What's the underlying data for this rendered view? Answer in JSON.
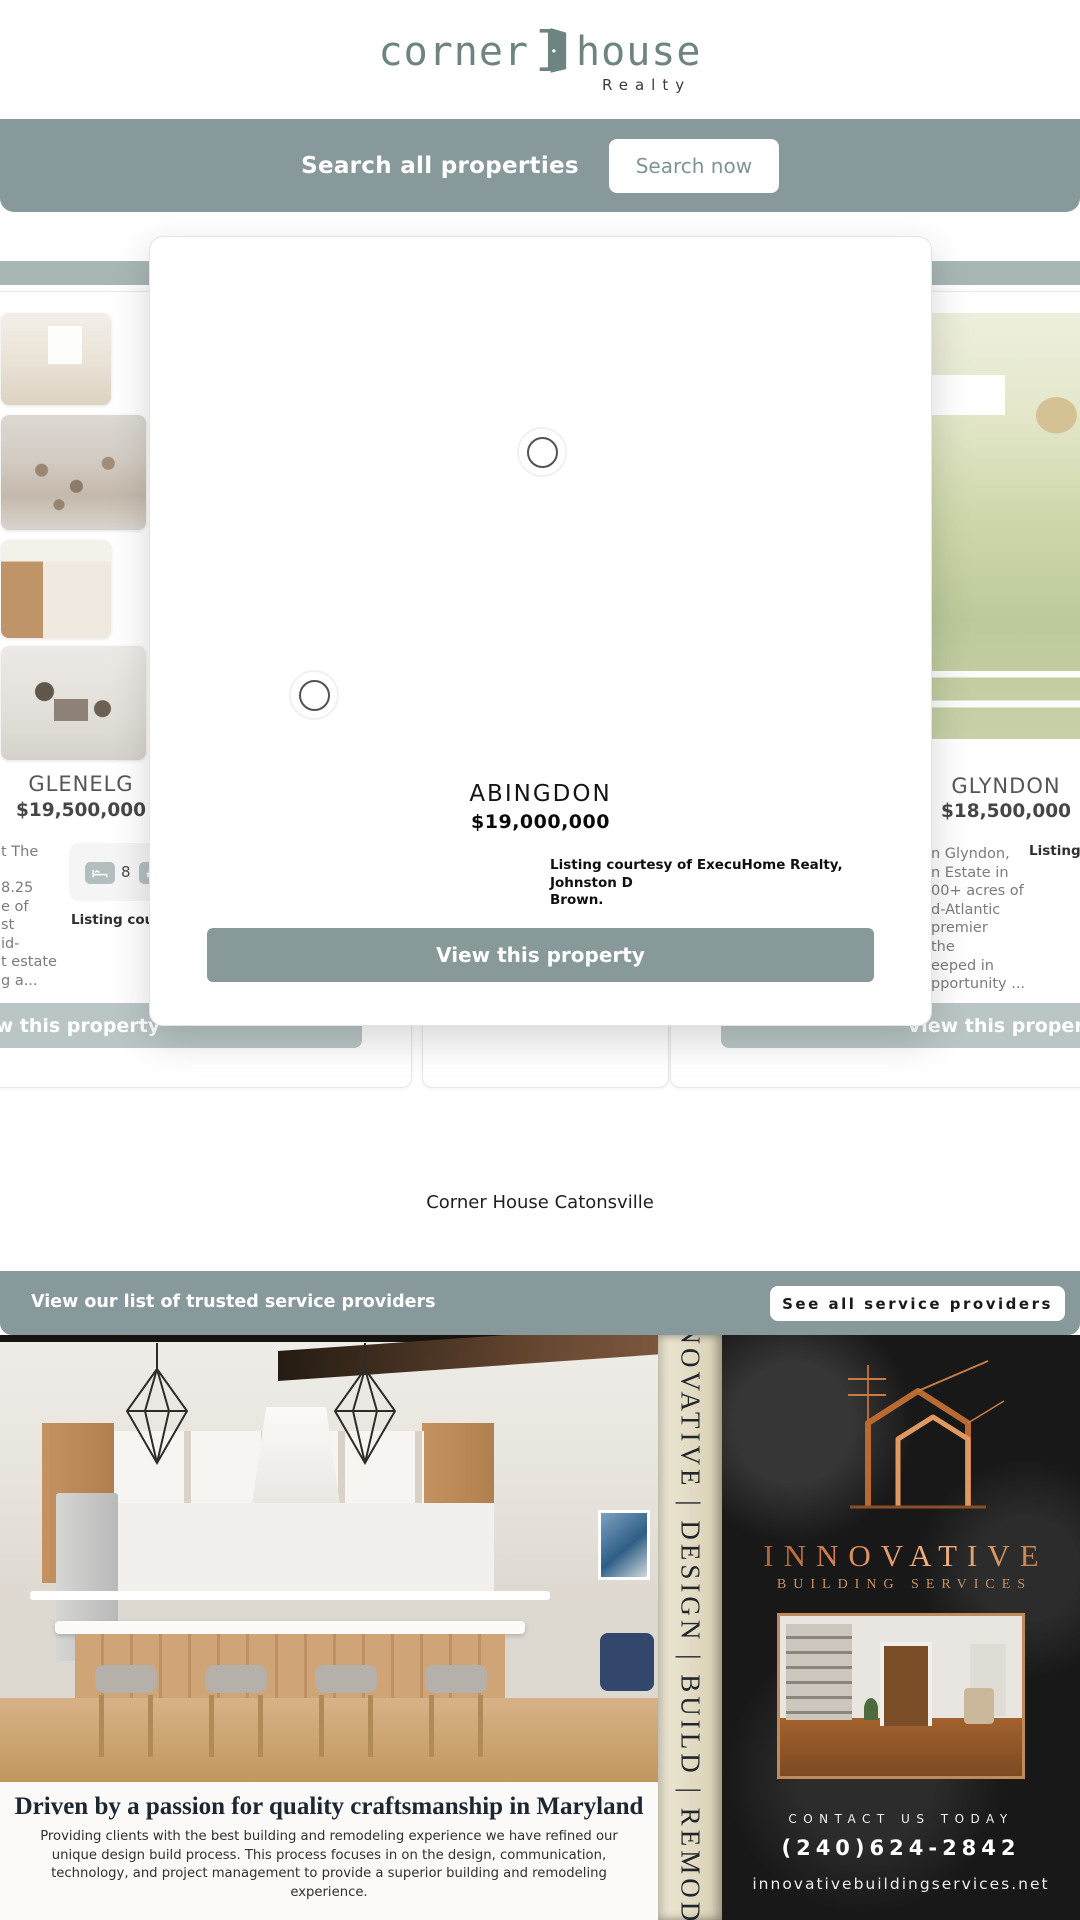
{
  "header": {
    "logo_left": "corner",
    "logo_right": "house",
    "logo_sub": "Realty"
  },
  "search": {
    "label": "Search all properties",
    "button_label": "Search now"
  },
  "modal": {
    "title": "ABINGDON",
    "price": "$19,000,000",
    "courtesy_line1": "Listing courtesy of ExecuHome Realty, Johnston D",
    "courtesy_line2": "Brown.",
    "cta_label": "View this property"
  },
  "listings": {
    "left": {
      "title": "GLENELG",
      "price": "$19,500,000",
      "beds": "8",
      "desc_lines": [
        "t The",
        "8.25",
        "e of",
        "st",
        "id-",
        "t estate",
        "g a..."
      ],
      "listing_note": "Listing courtesy",
      "button_label": "View this property"
    },
    "right": {
      "title": "GLYNDON",
      "price": "$18,500,000",
      "desc_lines": [
        "n Glyndon,",
        "n Estate in",
        "00+ acres of",
        "d-Atlantic",
        "premier",
        "the",
        "eeped in",
        "pportunity ..."
      ],
      "listing_note": "Listing courtesy of ...",
      "button_label": "View this property"
    },
    "location_label": "Corner House Catonsville"
  },
  "providers": {
    "label": "View our list of trusted service providers",
    "button_label": "See all service providers"
  },
  "ad": {
    "vertical_text": "INNOVATIVE | DESIGN | BUILD | REMODEL",
    "brand": "INNOVATIVE",
    "brand_sub": "BUILDING SERVICES",
    "headline": "Driven by a passion for quality craftsmanship in Maryland",
    "body": "Providing clients with the best building and remodeling experience we have refined our unique design build process. This process focuses in on the design, communication, technology, and project management to provide a superior building and remodeling experience.",
    "contact_label": "CONTACT US TODAY",
    "phone": "(240)624-2842",
    "website": "innovativebuildingservices.net"
  },
  "colors": {
    "accent_sage": "#87999b",
    "accent_copper": "#c0703c",
    "modal_button": "#879a99"
  }
}
